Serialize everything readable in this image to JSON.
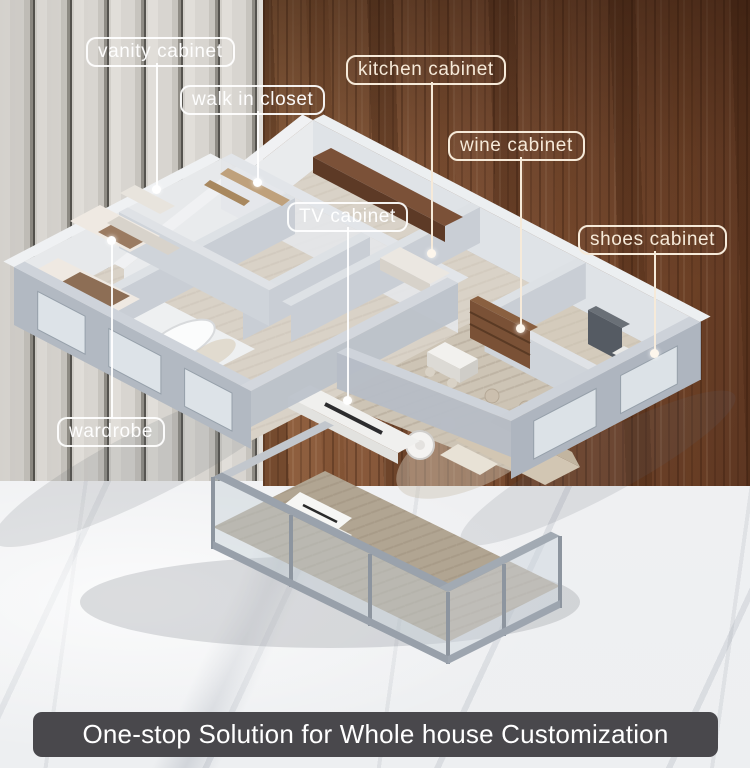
{
  "callouts": [
    {
      "text": "vanity cabinet"
    },
    {
      "text": "walk in closet"
    },
    {
      "text": "kitchen cabinet"
    },
    {
      "text": "wine cabinet"
    },
    {
      "text": "TV cabinet"
    },
    {
      "text": "shoes cabinet"
    },
    {
      "text": "wardrobe"
    }
  ],
  "banner": {
    "text": "One-stop Solution for Whole house Customization"
  },
  "palette": {
    "callout_white": "#ffffff",
    "callout_cream": "#f6ead9",
    "banner_bg": "#49484c",
    "banner_text": "#ffffff",
    "wood_panel": "#7c4c2f",
    "fluted_panel": "#d8d5d0",
    "marble": "#f2f1f3",
    "wall_gray": "#c3c9d1",
    "living_floor": "#b7ab9b"
  }
}
